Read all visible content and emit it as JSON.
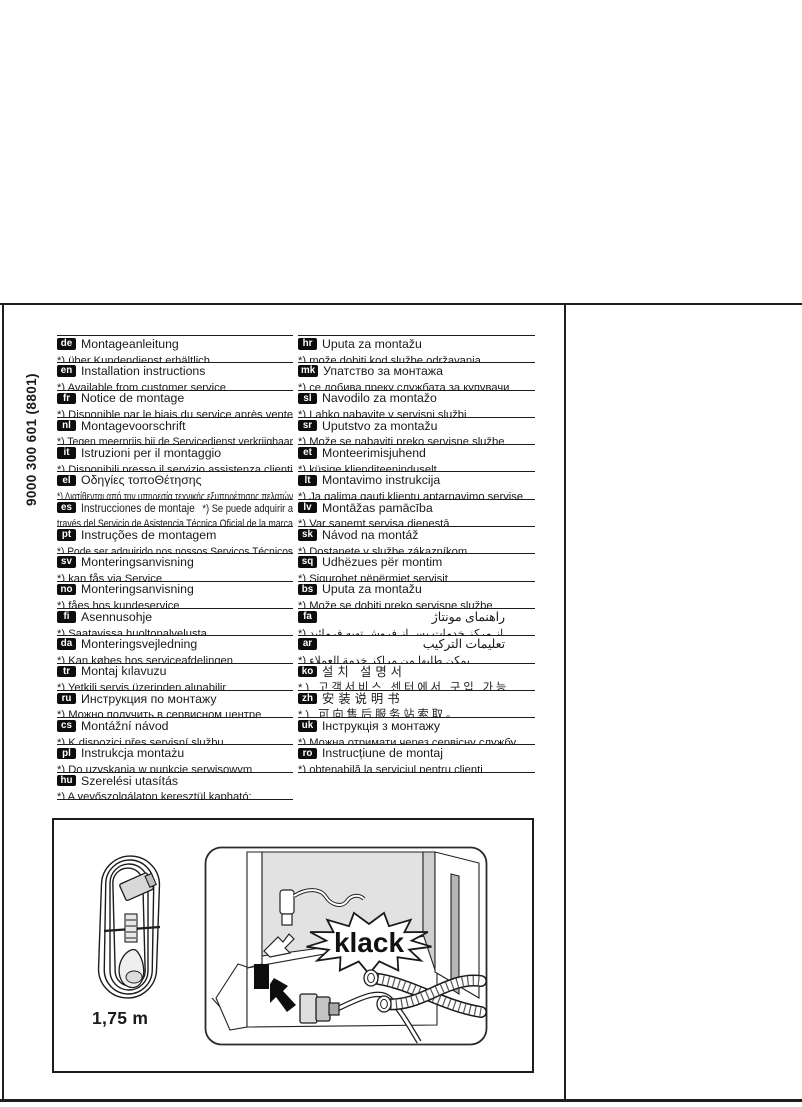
{
  "page": {
    "code_vertical": "9000 300 601  (8801)"
  },
  "columns": {
    "left": [
      {
        "code": "de",
        "title": "Montageanleitung",
        "note": "*) über Kundendienst erhältlich"
      },
      {
        "code": "en",
        "title": "Installation instructions",
        "note": "*) Available from customer service"
      },
      {
        "code": "fr",
        "title": "Notice de montage",
        "note": "*) Disponible par le biais du service après vente"
      },
      {
        "code": "nl",
        "title": "Montagevoorschrift",
        "note": "*) Tegen meerprijs bij de Servicedienst verkrijgbaar"
      },
      {
        "code": "it",
        "title": "Istruzioni per il montaggio",
        "note": "*) Disponibili presso il servizio assistenza clienti"
      },
      {
        "code": "el",
        "title": "Οδηγίες τοποΘέτησης",
        "note": "*) Διατίθενται από την υπηρεσία τεχνικής εξυπηρέτησης πελατών"
      },
      {
        "code": "es",
        "title": "Instrucciones de montaje",
        "title_suffix": "*) Se puede adquirir a",
        "note": "través del Servicio de Asistencia Técnica Oficial de la marca"
      },
      {
        "code": "pt",
        "title": "Instruções de montagem",
        "note": "*) Pode ser adquirido nos nossos Serviços Técnicos"
      },
      {
        "code": "sv",
        "title": "Monteringsanvisning",
        "note": "*) kan fås via Service"
      },
      {
        "code": "no",
        "title": "Monteringsanvisning",
        "note": "*) fåes hos kundeservice"
      },
      {
        "code": "fi",
        "title": "Asennusohje",
        "note": "*) Saatavissa huoltopalvelusta"
      },
      {
        "code": "da",
        "title": "Monteringsvejledning",
        "note": "*) Kan købes hos serviceafdelingen"
      },
      {
        "code": "tr",
        "title": "Montaj kılavuzu",
        "note": "*) Yetkili servis üzerinden alınabilir"
      },
      {
        "code": "ru",
        "title": "Инструкция по монтажу",
        "note": "*) Можно получить в сервисном центре"
      },
      {
        "code": "cs",
        "title": "Montážní návod",
        "note": "*) K dispozici přes servisní službu"
      },
      {
        "code": "pl",
        "title": "Instrukcja montażu",
        "note": "*) Do uzyskania w punkcie serwisowym"
      },
      {
        "code": "hu",
        "title": "Szerelési utasítás",
        "note": "*) A vevőszolgálaton keresztül kapható:"
      }
    ],
    "right": [
      {
        "code": "hr",
        "title": "Uputa za montažu",
        "note": "*) može dobiti kod službe održavanja"
      },
      {
        "code": "mk",
        "title": "Упатство за монтажа",
        "note": "*) се добива преку службата за купувачи"
      },
      {
        "code": "sl",
        "title": "Navodilo za montažo",
        "note": "*) Lahko nabavite v servisni službi"
      },
      {
        "code": "sr",
        "title": "Uputstvo za montažu",
        "note": "*) Može se nabaviti preko servisne službe"
      },
      {
        "code": "et",
        "title": "Monteerimisjuhend",
        "note": "*) küsige klienditeeninduselt"
      },
      {
        "code": "lt",
        "title": "Montavimo instrukcija",
        "note": "*) Ją galima gauti klientų aptarnavimo servise"
      },
      {
        "code": "lv",
        "title": "Montāžas pamācība",
        "note": "*) Var saņemt servisa dienestā"
      },
      {
        "code": "sk",
        "title": "Návod na montáž",
        "note": "*) Dostanete v službe zákazníkom"
      },
      {
        "code": "sq",
        "title": "Udhëzues për montim",
        "note": "*) Sigurohet nëpërmjet servisit"
      },
      {
        "code": "bs",
        "title": "Uputa za montažu",
        "note": "*) Može se dobiti preko servisne službe"
      },
      {
        "code": "fa",
        "title": "راهنمای مونتاژ",
        "note": "*) از مرکز خدمات پس از فروش تهیه فرمائید"
      },
      {
        "code": "ar",
        "title": "تعليمات التركيب",
        "note": "*) يمكن طلبها من مراكز خدمة العملاء"
      },
      {
        "code": "ko",
        "title": "설치 설명서",
        "note": "*) 고객서비스 센터에서 구입 가능"
      },
      {
        "code": "zh",
        "title": "安装说明书",
        "note": "*) 可向售后服务站索取。"
      },
      {
        "code": "uk",
        "title": "Інструкція з монтажу",
        "note": "*) Можна отримати через сервісну службу"
      },
      {
        "code": "ro",
        "title": "Instrucțiune de montaj",
        "note": "*) obtenabilă la serviciul pentru clienți"
      }
    ]
  },
  "figure": {
    "cable_length_label": "1,75 m",
    "sound_label": "klack",
    "icons": {
      "cable": "coiled-power-cable-icon",
      "illustration": "dishwasher-rear-plug-connection-illustration"
    }
  },
  "colors": {
    "ink": "#1c1c1c",
    "panel_gray": "#e2e2e2",
    "plug_gray": "#cfcfcf"
  }
}
